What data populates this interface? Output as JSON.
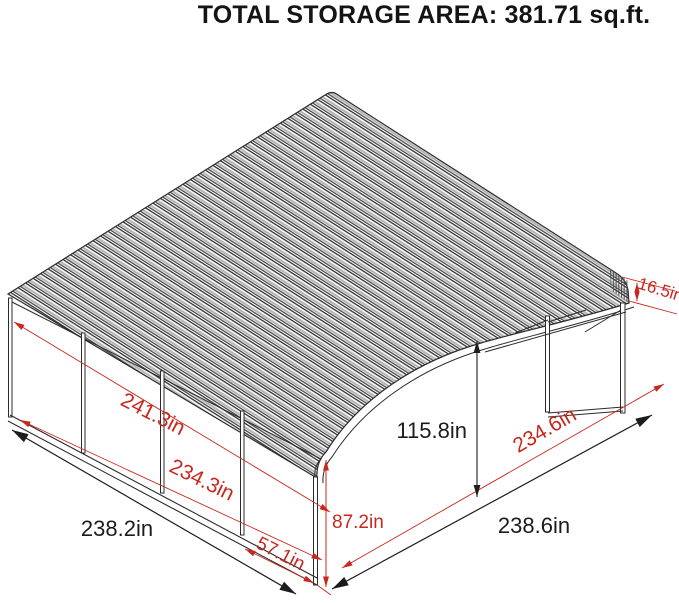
{
  "title": "TOTAL STORAGE AREA: 381.71 sq.ft.",
  "diagram": {
    "type": "carport-dimension-drawing",
    "units": "inches"
  },
  "dimensions": {
    "roof_edge_height": "16.5in",
    "side_wall_top_length": "241.3in",
    "side_wall_panel_length": "234.3in",
    "front_bay_width": "57.1in",
    "eave_height": "87.2in",
    "peak_height": "115.8in",
    "open_side_depth": "234.6in",
    "base_width_left": "238.2in",
    "base_width_right": "238.6in"
  },
  "colors": {
    "dimension_accent": "#c8271e",
    "structure_line": "#2b2b2b",
    "roof_shade": "#b5b5b5"
  }
}
